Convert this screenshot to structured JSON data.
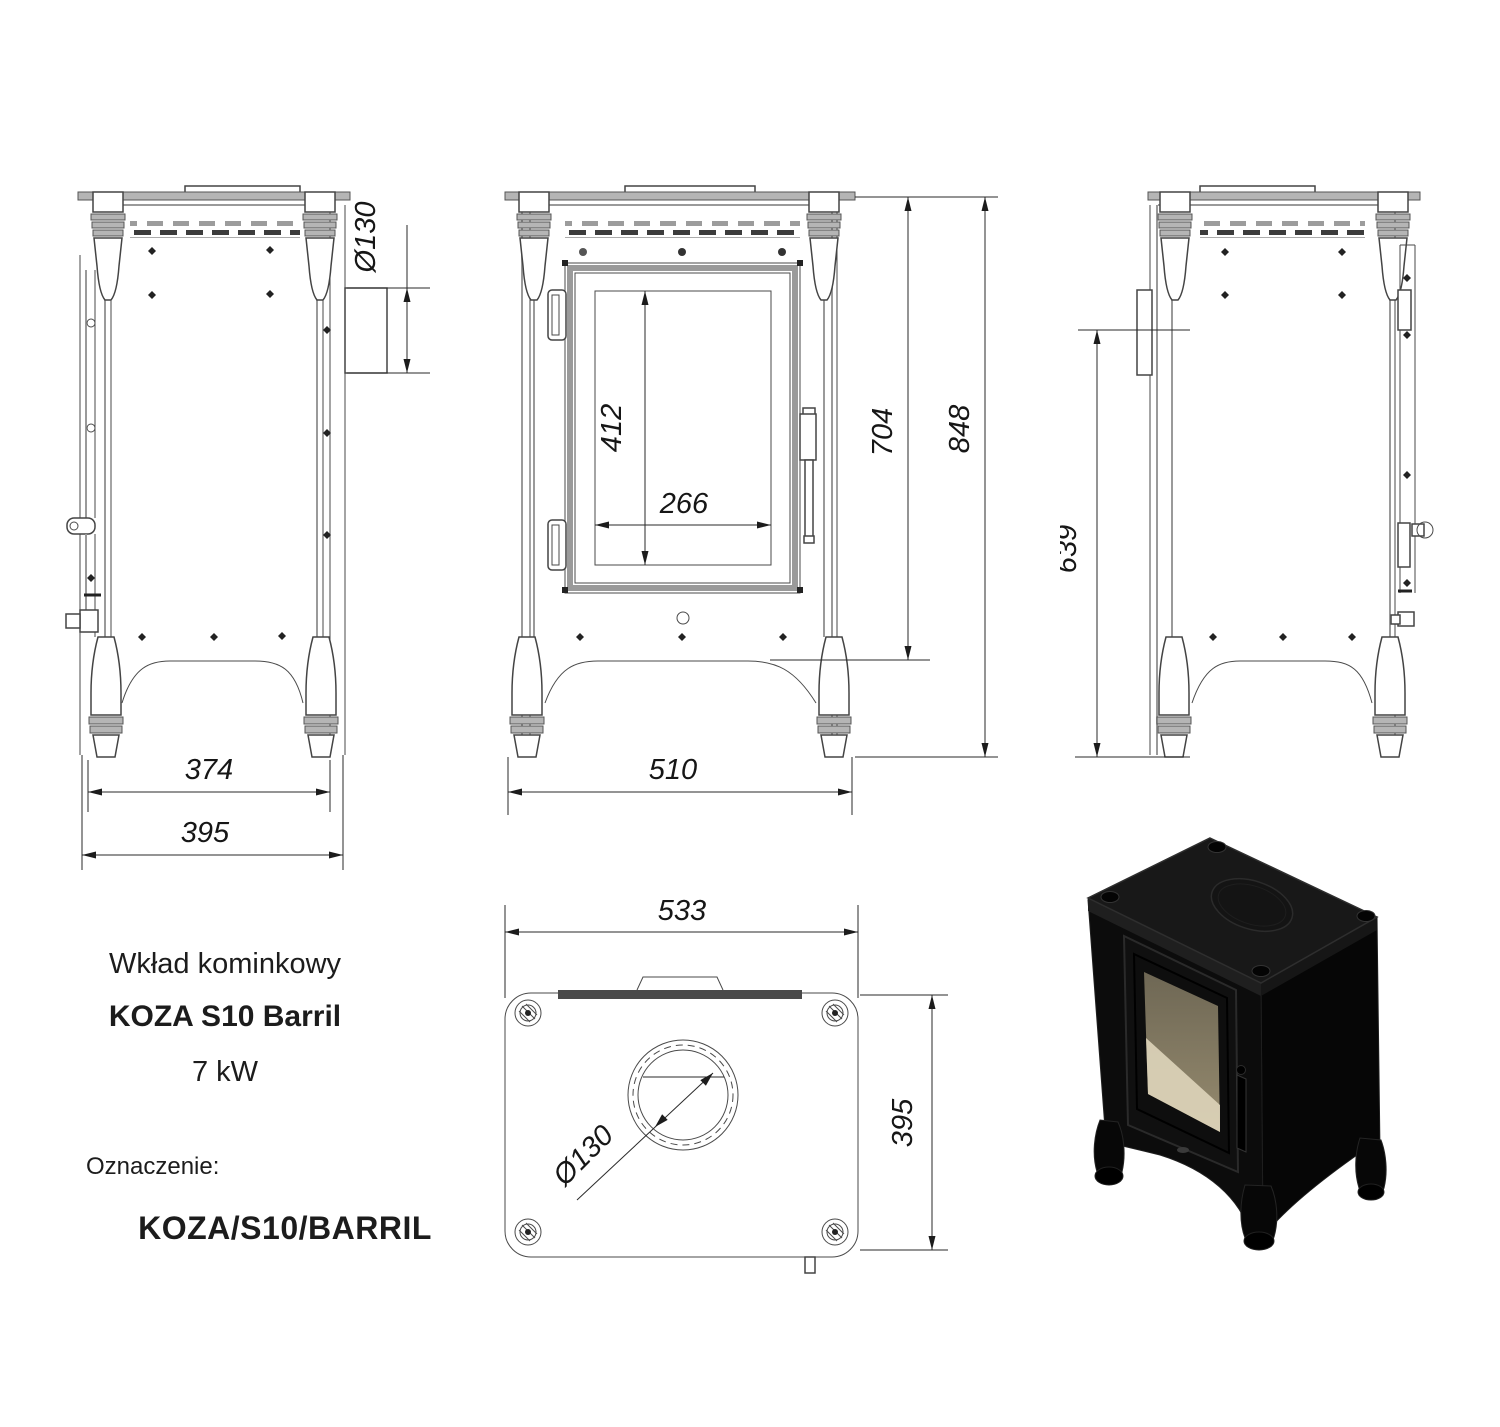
{
  "product": {
    "category": "Wkład kominkowy",
    "model": "KOZA S10 Barril",
    "power": "7 kW",
    "designation_label": "Oznaczenie:",
    "designation_code": "KOZA/S10/BARRIL"
  },
  "dimensions_mm": {
    "back_view": {
      "flue_diameter": "Ø130",
      "leg_spacing": "374",
      "overall_width": "395"
    },
    "front_view": {
      "glass_height": "412",
      "glass_width": "266",
      "body_height": "704",
      "overall_height": "848",
      "overall_width": "510"
    },
    "side_view": {
      "flue_axis_height": "639"
    },
    "top_view": {
      "overall_depth": "533",
      "overall_width": "395",
      "flue_diameter": "Ø130"
    }
  },
  "colors": {
    "background": "#ffffff",
    "drawing_line": "#3d3d3d",
    "dimension_text": "#161616",
    "stove_body": "#0d0d0d",
    "glass_tint": "#cfc6ae"
  }
}
